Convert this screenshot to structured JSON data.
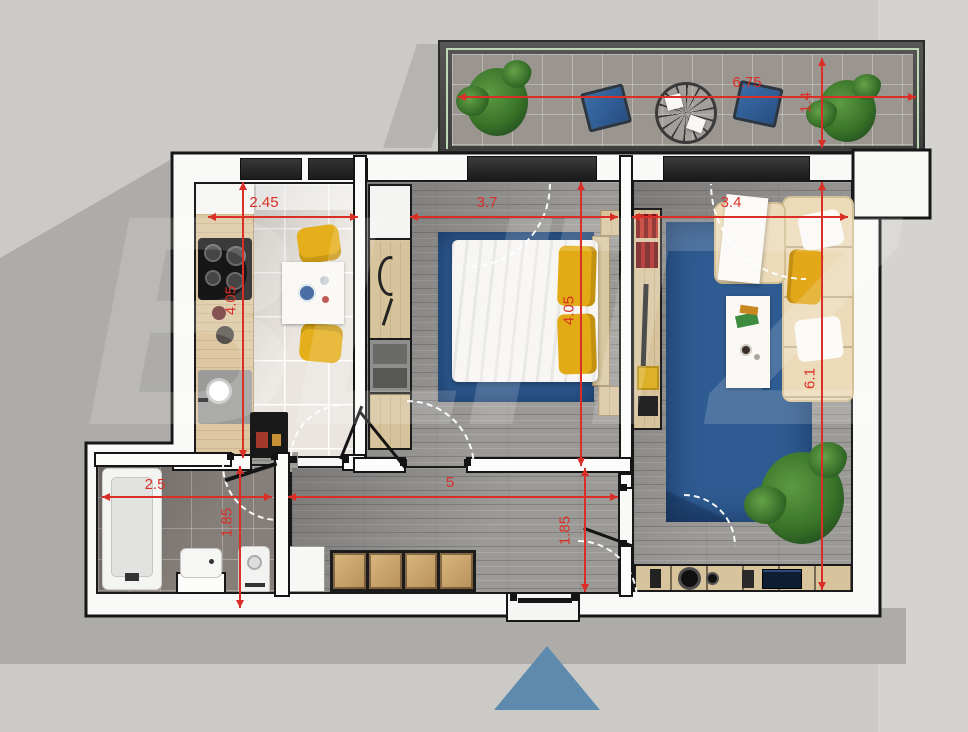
{
  "watermark": "BLITZ",
  "colors": {
    "background": "#cbcac6",
    "shadow": "#adaca8",
    "walls": "#f9f9f8",
    "wall_outline": "#161616",
    "dimension_red": "#d92f26",
    "rug_blue": "#2e5b91",
    "accent_yellow": "#e2ab16",
    "sofa_cream": "#ecdbb9",
    "wood_light": "#dcc7a0",
    "floor_grey": "#9c9a97",
    "plant_green": "#3f7d35",
    "marker_blue": "#5e8aad",
    "railing_green": "#bcd8b4"
  },
  "rooms": {
    "balcony": {
      "width": "6.75",
      "depth": "1.4",
      "items": [
        "plant",
        "armchair",
        "round table",
        "armchair",
        "plant"
      ]
    },
    "kitchen": {
      "width": "2.45",
      "depth": "4.05",
      "items": [
        "counter",
        "stove",
        "sink",
        "fridge",
        "dining table",
        "yellow chairs"
      ]
    },
    "bedroom": {
      "width": "3.7",
      "depth": "4.05",
      "items": [
        "wardrobe column",
        "double bed",
        "yellow pillows",
        "blue rug",
        "nightstands"
      ]
    },
    "living": {
      "width": "3.4",
      "depth": "6.1",
      "items": [
        "media wall",
        "corner sofa",
        "coffee table",
        "blue rug",
        "tv console",
        "plant"
      ]
    },
    "bathroom": {
      "width": "2.5",
      "depth": "1.85",
      "items": [
        "bathtub",
        "sink",
        "washing machine"
      ]
    },
    "hallway": {
      "width": "5",
      "depth": "1.85",
      "items": [
        "cabinet",
        "wardrobes",
        "entrance door"
      ]
    }
  },
  "marker": {
    "shape": "triangle"
  }
}
